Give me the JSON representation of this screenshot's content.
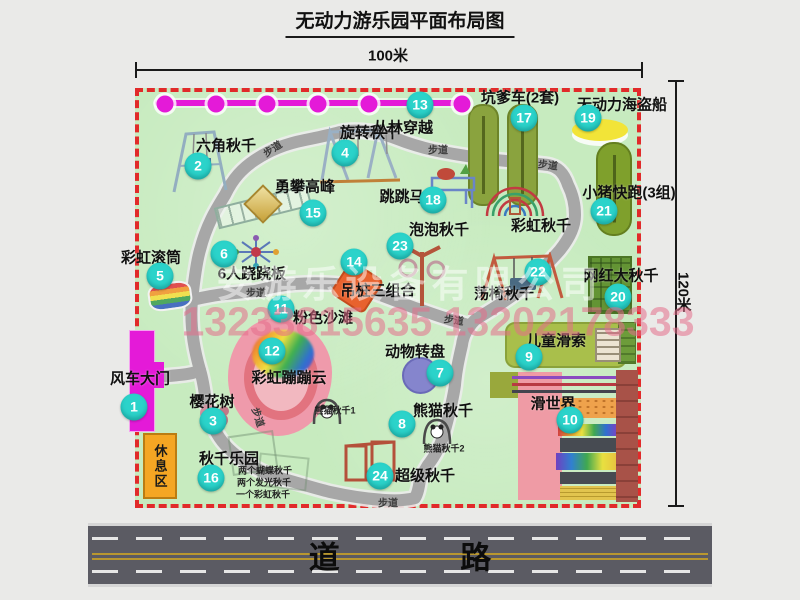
{
  "title": "无动力游乐园平面布局图",
  "dimensions": {
    "width": "100米",
    "height": "120米"
  },
  "watermark": {
    "company": "安游乐设备有限公司",
    "phones": "13233815635 13202178333"
  },
  "map": {
    "path_label": "步道",
    "rest_area_label": "休息区",
    "road_label": "道 路",
    "rainbow_swing": "彩虹秋千"
  },
  "attractions": [
    {
      "num": "1",
      "name": "风车大门"
    },
    {
      "num": "2",
      "name": "六角秋千"
    },
    {
      "num": "3",
      "name": "樱花树"
    },
    {
      "num": "4",
      "name": "旋转秋千"
    },
    {
      "num": "5",
      "name": "彩虹滚筒"
    },
    {
      "num": "6",
      "name": "6人跷跷板"
    },
    {
      "num": "7",
      "name": "动物转盘"
    },
    {
      "num": "8",
      "name": "熊猫秋千",
      "sub1": "熊猫秋千1",
      "sub2": "熊猫秋千2"
    },
    {
      "num": "9",
      "name": "儿童滑索"
    },
    {
      "num": "10",
      "name": "滑世界"
    },
    {
      "num": "11",
      "name": "粉色沙滩"
    },
    {
      "num": "12",
      "name": "彩虹蹦蹦云"
    },
    {
      "num": "13",
      "name": "丛林穿越"
    },
    {
      "num": "14",
      "name": "吊桩三组合"
    },
    {
      "num": "15",
      "name": "勇攀高峰"
    },
    {
      "num": "16",
      "name": "秋千乐园",
      "notes": [
        "两个蝴蝶秋千",
        "两个发光秋千",
        "一个彩虹秋千"
      ]
    },
    {
      "num": "17",
      "name": "坑爹车(2套)"
    },
    {
      "num": "18",
      "name": "跳跳马"
    },
    {
      "num": "19",
      "name": "无动力海盗船"
    },
    {
      "num": "20",
      "name": "网红大秋千"
    },
    {
      "num": "21",
      "name": "小猪快跑(3组)"
    },
    {
      "num": "22",
      "name": "荡椅秋千"
    },
    {
      "num": "23",
      "name": "泡泡秋千"
    },
    {
      "num": "24",
      "name": "超级秋千"
    }
  ],
  "colors": {
    "map_bg": "#c7ebbf",
    "border": "#e12a2a",
    "badge": "#2bd3ca",
    "magenta": "#e41ad8",
    "path": "#a7a7a7",
    "road": "#5b5b63"
  }
}
